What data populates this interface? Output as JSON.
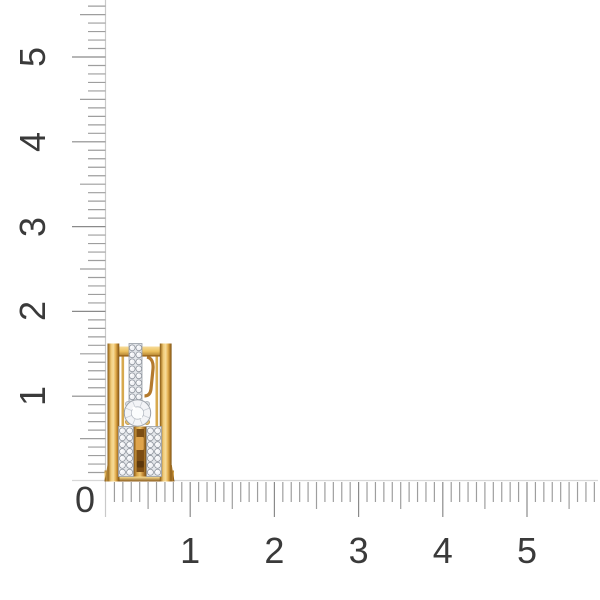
{
  "page": {
    "background": "#ffffff",
    "subject": "Gold earring with pave diamond rows photographed on white with measuring rulers along the left and bottom edges"
  },
  "rulers": {
    "origin_label": "0",
    "horizontal_labels": [
      "1",
      "2",
      "3",
      "4",
      "5"
    ],
    "vertical_labels": [
      "1",
      "2",
      "3",
      "4",
      "5"
    ],
    "colors": {
      "tick": "#9e9e9e",
      "major_tick": "#8a8a8a",
      "baseline": "#d7d7d7",
      "axis_line": "#c9c9c9",
      "label": "#3a3a3a"
    },
    "scale": {
      "h_origin_x": 106,
      "h_px_per_unit": 84.2,
      "h_max_units": 5.8,
      "v_origin_y": 481,
      "v_px_per_unit": 84.8,
      "v_max_units": 5.6,
      "minor_per_unit": 10
    }
  },
  "earring": {
    "description": "Wide gold hoop earring, side view: polished outer gold rails, a central vertical pave diamond row, a larger round center diamond, and two lower pave diamond rows flanking a gold bar with the clip post visible",
    "colors": {
      "gold_dark": "#7a5216",
      "gold_deep": "#a06c20",
      "gold_mid": "#e3ae4e",
      "gold_light": "#f0cb79",
      "gold_highlight": "#f7dc9a",
      "gold_brown": "#b47a2e",
      "post_brown": "#7d4e14",
      "slot_brown": "#5c380d",
      "strip_bg": "#e3e6ea",
      "strip_edge": "#979da6",
      "stone_fill": "#f2f3f6",
      "stone_edge": "#868c95",
      "diamond_fill": "#f3f4f7",
      "diamond_edge": "#9aa0a8",
      "facet_line": "#c8cdd4",
      "sparkle": "#ffffff"
    }
  }
}
